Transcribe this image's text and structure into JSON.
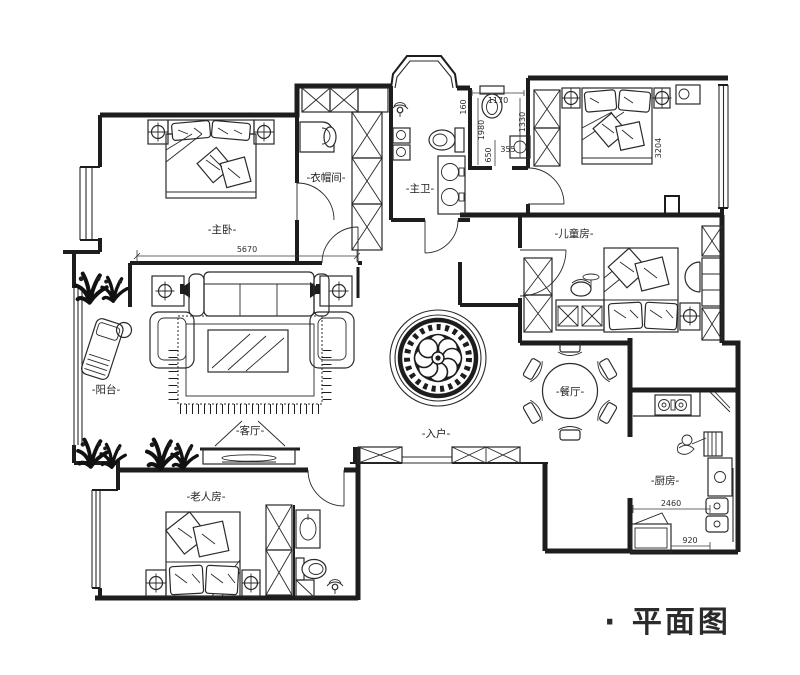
{
  "title": "· 平面图",
  "rooms": {
    "master_bedroom": "-主卧-",
    "cloakroom": "-衣帽间-",
    "master_bathroom": "-主卫-",
    "children_room": "-儿童房-",
    "balcony": "-阳台-",
    "living_room": "-客厅-",
    "entrance": "-入户-",
    "dining_room": "-餐厅-",
    "kitchen": "-厨房-",
    "elder_room": "-老人房-"
  },
  "dimensions": {
    "master_width": "5670",
    "bath_width": "1170",
    "bath_offset": "160",
    "bath_depth": "1980",
    "wc_depth": "1330",
    "niche_depth": "650",
    "niche_width": "355",
    "room_depth": "3204",
    "kitchen_width": "2460",
    "fridge_width": "920"
  },
  "colors": {
    "line": "#1d1d1d",
    "background": "#ffffff"
  },
  "icons": {
    "ceiling-light": "circle-with-cross",
    "plant": "black-branch-scribble",
    "shower-head": "sprinkler-arcs",
    "floor-medallion": "concentric-flower-circles",
    "toilet": "oval-bowl-with-tank",
    "sink": "circle-basin",
    "stove": "two-burner-circles",
    "fridge": "rect-with-open-door",
    "tv": "thin-ellipse-on-cabinet",
    "dining-table": "round-table-six-chairs"
  }
}
